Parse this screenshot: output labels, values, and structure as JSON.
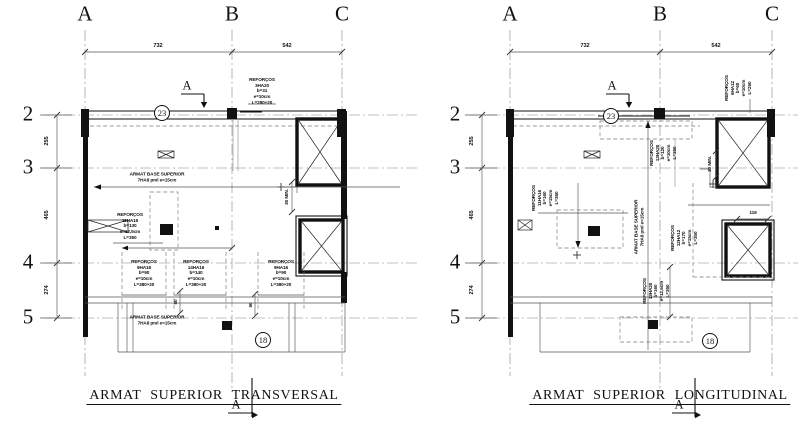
{
  "colors": {
    "background": "#ffffff",
    "ink": "#111111",
    "grid_line": "#858585",
    "thin_line": "#555555"
  },
  "left": {
    "title": "ARMAT SUPERIOR TRANSVERSAL",
    "section_label": "A",
    "cols": [
      "A",
      "B",
      "C"
    ],
    "rows": [
      "2",
      "3",
      "4",
      "5"
    ],
    "top_dims": [
      "732",
      "542"
    ],
    "side_dims": [
      "255",
      "465",
      "274"
    ],
    "bubble_top": "23",
    "bubble_bottom": "18",
    "ann": {
      "reinf_top": "REFORÇOS\n3HA20\nb=31\ne=10cm\nL=280+20",
      "base_mid": "ARMAT BASE SUPERIOR\n7HA8 pml  e=15cm",
      "reinf_mid": "REFORÇOS\n11HA16\nb=130\ne=12,5cm\nL=350",
      "reinf_b1": "REFORÇOS\n9HA16\nb=90\ne=10cm\nL=380+20",
      "reinf_b2": "REFORÇOS\n14HA16\nb=140\ne=10cm\nL=380+20",
      "reinf_b3": "REFORÇOS\n9HA16\nb=90\ne=10cm\nL=380+20",
      "base_bottom": "ARMAT BASE SUPERIOR\n7HA8 pml  e=15cm",
      "min30": "30 MIN.",
      "dim50_a": "50",
      "dim50_b": "50"
    }
  },
  "right": {
    "title": "ARMAT SUPERIOR LONGITUDINAL",
    "section_label": "A",
    "cols": [
      "A",
      "B",
      "C"
    ],
    "rows": [
      "2",
      "3",
      "4",
      "5"
    ],
    "top_dims": [
      "732",
      "542"
    ],
    "side_dims": [
      "255",
      "465",
      "274"
    ],
    "bubble_top": "23",
    "bubble_bottom": "18",
    "ann": {
      "reinf_c_top": "REFORÇOS\n6HA12\nb=60\ne=10cm\nL=250",
      "reinf_b_top": "REFORÇOS\n13HA20\nb=120\ne=10cm\nL=350",
      "reinf_mid": "REFORÇOS\n11HA16\nb=160\ne=15cm\nL=350",
      "base_mid": "ARMAT BASE SUPERIOR\n7HA8 pml  e=15cm",
      "reinf_c_mid": "REFORÇOS\n12HA12\nb=170\ne=15cm\nL=300",
      "min30": "30 MIN.",
      "dim119": "119",
      "reinf_bottom": "REFORÇOS\n13HA20\nb=160\ne=12,5cm\nL=350"
    }
  }
}
